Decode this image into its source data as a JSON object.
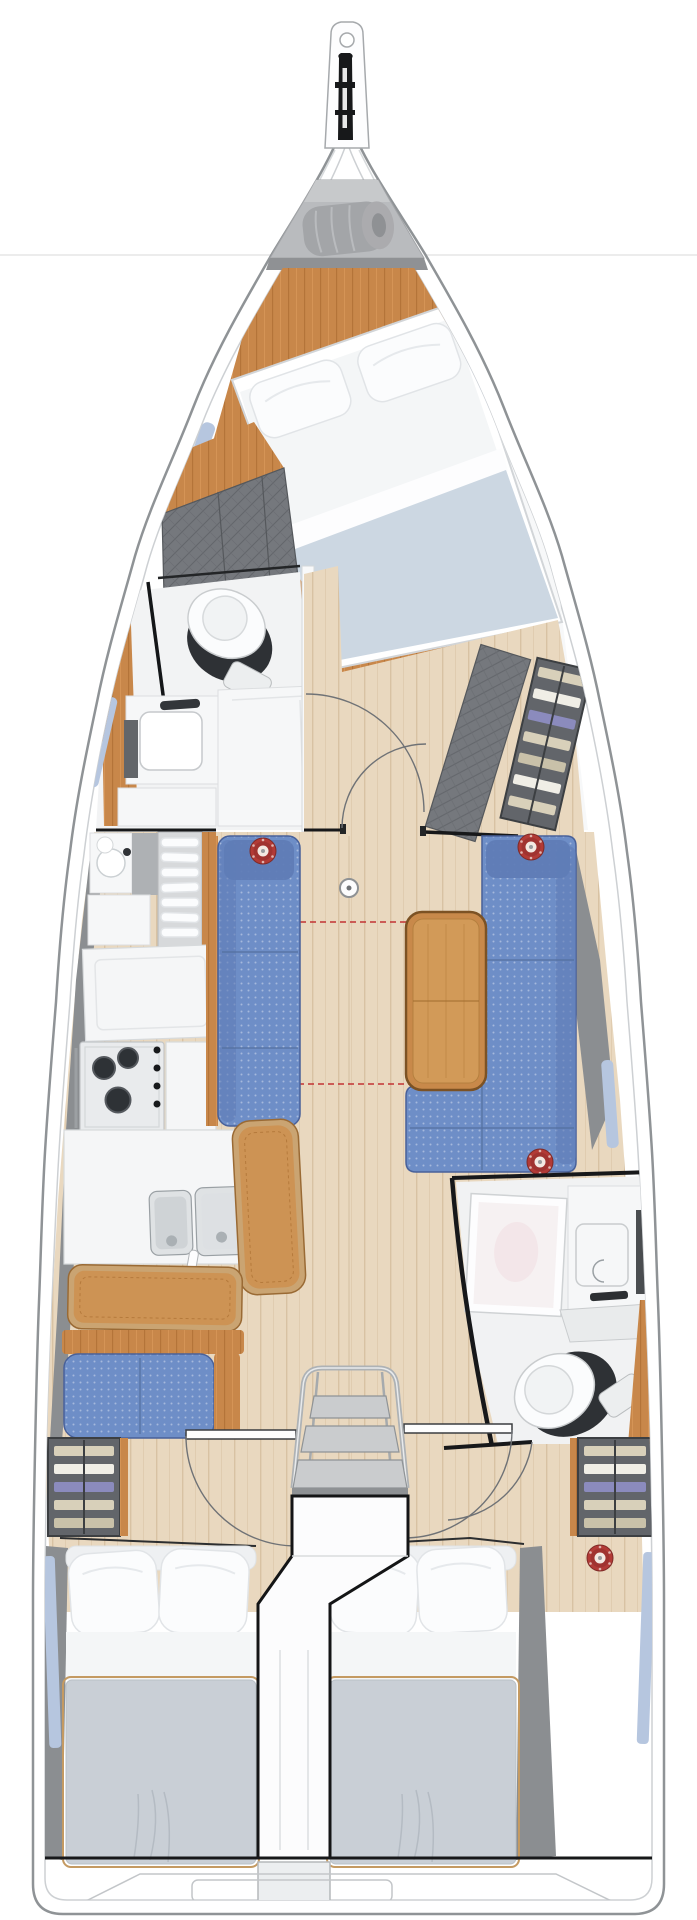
{
  "diagram": {
    "type": "sailing-yacht-interior-floor-plan-top-view",
    "orientation": "bow-up",
    "visible_text": "",
    "cabins_count": 3,
    "heads_count": 2,
    "speaker_count": 5
  },
  "colors": {
    "page_line": "#e6e6e6",
    "hull_stroke": "#8f9396",
    "inner_liner": "#cdd0d3",
    "anchor_locker": "#b9bbbe",
    "locker_band": "#8f9194",
    "sail_bag": "#a3a5a8",
    "cabin_wood": "#c8874a",
    "floor_wood": "#e9d8bf",
    "floor_streak": "#d8c2a3",
    "sofa_blue": "#6e8ec7",
    "sofa_back": "#5f7cb6",
    "sofa_outline": "#49619a",
    "bench_tan": "#cd9354",
    "bench_rim": "#caa472",
    "bench_edge": "#9a6a34",
    "table_wood": "#c8894a",
    "table_inner": "#d29a58",
    "table_edge": "#7c5224",
    "counter_white": "#f5f6f7",
    "stainless": "#dfe2e4",
    "stove_steel": "#e9ebed",
    "burner_dark": "#2e3236",
    "mattress_fwd": "#ccd7e2",
    "mattress_aft": "#c9cfd6",
    "bedding_white": "#f4f6f7",
    "pillow_white": "#fbfcfd",
    "upholstery_gray": "#75787d",
    "hull_pad_gray": "#8b8e91",
    "wall_black": "#17181a",
    "window_blue": "#b6c6df",
    "speaker_red": "#b23a36",
    "speaker_inner": "#a03330",
    "speaker_center": "#f3e9e2",
    "dashed_red": "#c23333",
    "arc_gray": "#6f7276",
    "shelf_frame": "#62656a",
    "clothes_cream": "#d8d0ba",
    "clothes_white": "#f0eee6",
    "clothes_purple": "#8b8bbd",
    "clothes_tan": "#c9c1a9",
    "chrome": "#aeb2b5",
    "tread_gray": "#caccce"
  },
  "elements": [
    "bowsprit-anchor-roller",
    "anchor-locker",
    "sail-bag",
    "owner-cabin-double-berth",
    "owner-cabin-pillows",
    "forward-head-toilet",
    "forward-head-vanity-sink",
    "forward-head-shower",
    "hanging-lockers-gray",
    "salon-port-settee",
    "salon-starboard-l-sofa",
    "salon-folding-table",
    "table-extension-dashed-outline",
    "mast-compression-post",
    "door-swing-arcs",
    "starboard-shelving-with-clothes",
    "galley-round-sink-cabinet",
    "galley-dish-rack",
    "galley-refrigerator",
    "galley-worktop",
    "galley-gas-stove-3-burner",
    "galley-double-stainless-sink",
    "galley-tan-benches",
    "nav-seat-blue",
    "port-wardrobe-shelves",
    "starboard-wardrobe-shelves",
    "aft-head-shower",
    "aft-head-vanity-sink",
    "aft-head-toilet",
    "companionway-steps",
    "engine-compartment-box",
    "aft-cabin-port-double-berth",
    "aft-cabin-starboard-double-berth",
    "ceiling-speakers-red",
    "hull-windows-light-blue",
    "transom-swim-platform-lines"
  ]
}
